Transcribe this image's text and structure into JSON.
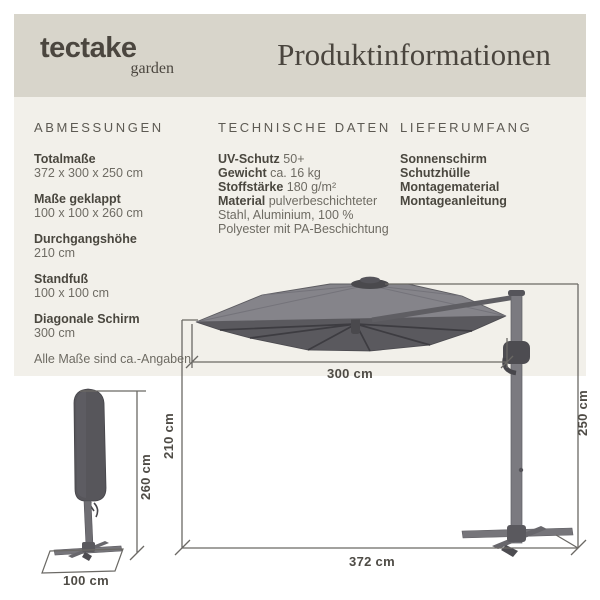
{
  "header": {
    "brand": "tectake",
    "brand_sub": "garden",
    "title": "Produktinformationen"
  },
  "columns": {
    "abmessungen": {
      "title": "ABMESSUNGEN",
      "items": [
        {
          "label": "Totalmaße",
          "value": "372 x 300 x 250 cm"
        },
        {
          "label": "Maße geklappt",
          "value": "100 x 100 x 260 cm"
        },
        {
          "label": "Durchgangshöhe",
          "value": "210 cm"
        },
        {
          "label": "Standfuß",
          "value": "100 x 100 cm"
        },
        {
          "label": "Diagonale Schirm",
          "value": "300 cm"
        }
      ],
      "note": "Alle Maße sind ca.-Angaben"
    },
    "technische_daten": {
      "title": "TECHNISCHE DATEN",
      "specs": [
        {
          "label": "UV-Schutz",
          "value": "50+"
        },
        {
          "label": "Gewicht",
          "value": "ca. 16 kg"
        },
        {
          "label": "Stoffstärke",
          "value": "180 g/m²"
        },
        {
          "label": "Material",
          "value": "pulverbeschichteter Stahl, Aluminium, 100 % Polyester mit PA-Beschichtung"
        }
      ]
    },
    "lieferumfang": {
      "title": "LIEFERUMFANG",
      "items": [
        "Sonnenschirm",
        "Schutzhülle",
        "Montagematerial",
        "Montageanleitung"
      ]
    }
  },
  "diagram": {
    "canopy_width": "300 cm",
    "passage_height": "210 cm",
    "total_height": "250 cm",
    "total_width": "372 cm",
    "folded_height": "260 cm",
    "base_width": "100 cm"
  },
  "colors": {
    "header_band": "#d8d5cb",
    "content_band": "#f2f0ea",
    "text_dark": "#4a473f",
    "text_medium": "#6e6b63",
    "canopy_top": "#85848a",
    "canopy_underside": "#5a595e",
    "frame_gray": "#77767b",
    "dimension_line": "#6b6965"
  }
}
